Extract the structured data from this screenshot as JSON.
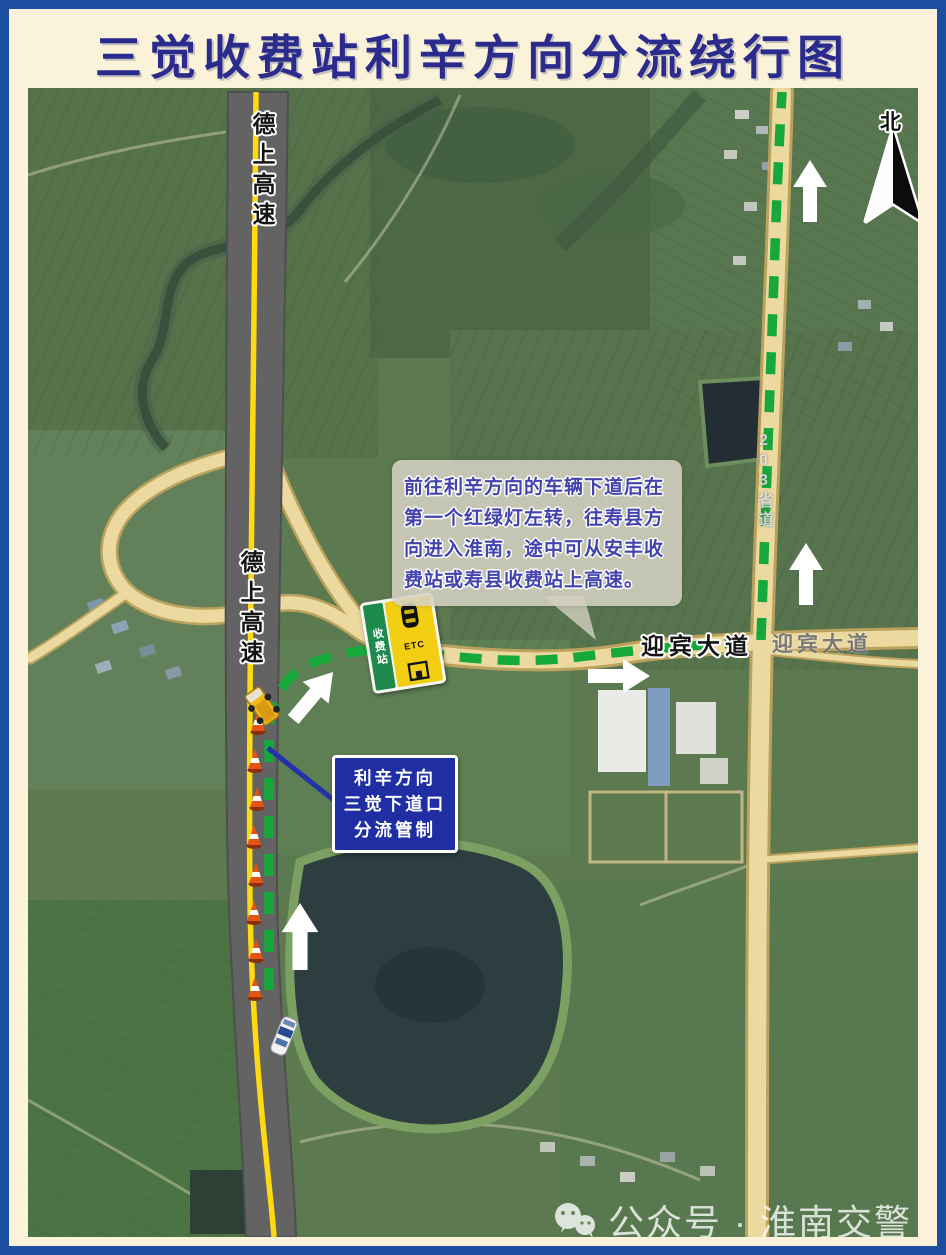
{
  "title": "三觉收费站利辛方向分流绕行图",
  "labels": {
    "expressway_top": "德上高速",
    "expressway_mid": "德上高速",
    "avenue_overlay": "迎宾大道",
    "avenue_basemap": "迎宾大道",
    "provincial_road": "203省道",
    "north": "北"
  },
  "callouts": {
    "detour_instruction": {
      "lines": [
        "前往利辛方向的车辆下道后在",
        "第一个红绿灯左转，往寿县方",
        "向进入淮南，途中可从安丰收",
        "费站或寿县收费站上高速。"
      ]
    },
    "control_notice": {
      "lines": [
        "利辛方向",
        "三觉下道口",
        "分流管制"
      ]
    }
  },
  "toll_sign": {
    "name": "收费站",
    "etc": "ETC"
  },
  "watermark": {
    "text": "公众号 · 淮南交警"
  },
  "colors": {
    "frame_blue": "#1d4fa1",
    "panel_cream": "#faf3da",
    "title_navy": "#2b2b8e",
    "route_green": "#17a83b",
    "expressway_gray": "#646464",
    "lane_yellow": "#ffd911",
    "local_road_tan": "#ecd9a0",
    "notice_blue": "#1f2ea2"
  }
}
